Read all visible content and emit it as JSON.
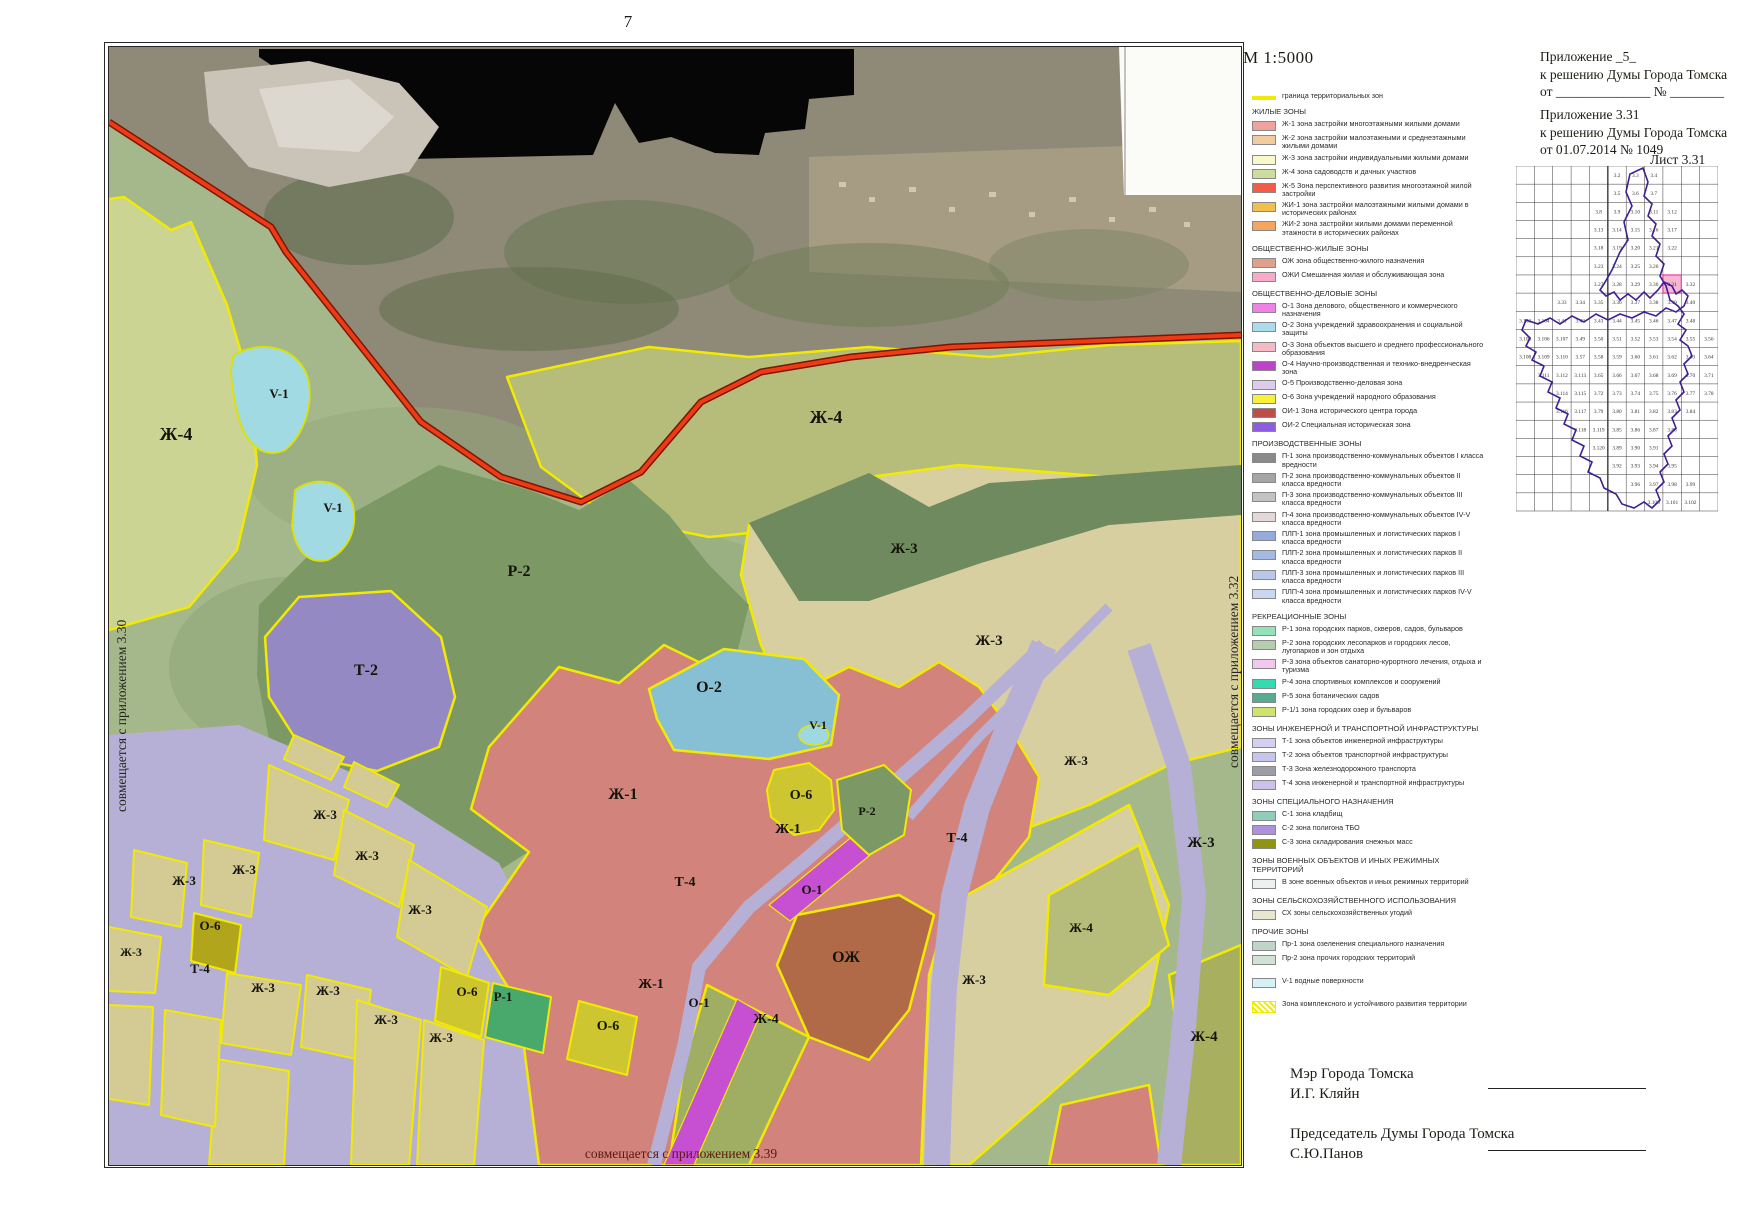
{
  "page": {
    "number": "7",
    "scale_label": "М 1:5000"
  },
  "header": {
    "appendix1": {
      "line1": "Приложение _5_",
      "line2": "к решению Думы Города Томска",
      "line3": "от ______________  № ________"
    },
    "appendix2": {
      "line1": "Приложение 3.31",
      "line2": "к решению Думы Города Томска",
      "line3": "от  01.07.2014  № 1049"
    },
    "sheet_label": "Лист 3.31"
  },
  "map": {
    "edge_captions": {
      "left": "совмещается с приложением 3.30",
      "right": "совмещается с приложением 3.32",
      "bottom": "совмещается с приложением 3.39"
    },
    "labels": [
      {
        "t": "Ж-4",
        "x": 67,
        "y": 393,
        "s": 18
      },
      {
        "t": "V-1",
        "x": 170,
        "y": 351,
        "s": 13
      },
      {
        "t": "V-1",
        "x": 224,
        "y": 465,
        "s": 13
      },
      {
        "t": "Ж-4",
        "x": 717,
        "y": 376,
        "s": 18
      },
      {
        "t": "Р-2",
        "x": 410,
        "y": 529,
        "s": 16
      },
      {
        "t": "Т-2",
        "x": 257,
        "y": 628,
        "s": 16
      },
      {
        "t": "Ж-3",
        "x": 795,
        "y": 506,
        "s": 15
      },
      {
        "t": "Ж-3",
        "x": 880,
        "y": 598,
        "s": 15
      },
      {
        "t": "О-2",
        "x": 600,
        "y": 645,
        "s": 16
      },
      {
        "t": "V-1",
        "x": 709,
        "y": 682,
        "s": 12
      },
      {
        "t": "Ж-1",
        "x": 514,
        "y": 752,
        "s": 16
      },
      {
        "t": "О-6",
        "x": 692,
        "y": 752,
        "s": 14
      },
      {
        "t": "Ж-1",
        "x": 679,
        "y": 786,
        "s": 14
      },
      {
        "t": "Р-2",
        "x": 758,
        "y": 768,
        "s": 12
      },
      {
        "t": "Т-4",
        "x": 848,
        "y": 795,
        "s": 14
      },
      {
        "t": "Ж-3",
        "x": 216,
        "y": 772,
        "s": 13
      },
      {
        "t": "Ж-3",
        "x": 258,
        "y": 813,
        "s": 13
      },
      {
        "t": "Ж-3",
        "x": 135,
        "y": 827,
        "s": 13
      },
      {
        "t": "Ж-3",
        "x": 75,
        "y": 838,
        "s": 13
      },
      {
        "t": "Ж-3",
        "x": 311,
        "y": 867,
        "s": 13
      },
      {
        "t": "О-6",
        "x": 101,
        "y": 883,
        "s": 13
      },
      {
        "t": "Ж-3",
        "x": 22,
        "y": 909,
        "s": 12
      },
      {
        "t": "Т-4",
        "x": 91,
        "y": 926,
        "s": 13
      },
      {
        "t": "Ж-3",
        "x": 154,
        "y": 945,
        "s": 13
      },
      {
        "t": "Ж-3",
        "x": 219,
        "y": 948,
        "s": 13
      },
      {
        "t": "О-6",
        "x": 358,
        "y": 949,
        "s": 13
      },
      {
        "t": "Р-1",
        "x": 394,
        "y": 954,
        "s": 13
      },
      {
        "t": "Ж-3",
        "x": 277,
        "y": 977,
        "s": 13
      },
      {
        "t": "Ж-3",
        "x": 332,
        "y": 995,
        "s": 13
      },
      {
        "t": "Т-4",
        "x": 576,
        "y": 839,
        "s": 14
      },
      {
        "t": "О-1",
        "x": 703,
        "y": 847,
        "s": 13
      },
      {
        "t": "Ж-1",
        "x": 542,
        "y": 941,
        "s": 14
      },
      {
        "t": "О-1",
        "x": 590,
        "y": 960,
        "s": 13
      },
      {
        "t": "О-6",
        "x": 499,
        "y": 983,
        "s": 14
      },
      {
        "t": "Ж-4",
        "x": 657,
        "y": 976,
        "s": 14
      },
      {
        "t": "ОЖ",
        "x": 737,
        "y": 915,
        "s": 16
      },
      {
        "t": "Ж-3",
        "x": 865,
        "y": 937,
        "s": 13
      },
      {
        "t": "Ж-4",
        "x": 972,
        "y": 885,
        "s": 13
      },
      {
        "t": "Ж-3",
        "x": 967,
        "y": 718,
        "s": 13
      },
      {
        "t": "Ж-3",
        "x": 1092,
        "y": 800,
        "s": 15
      },
      {
        "t": "Ж-4",
        "x": 1095,
        "y": 994,
        "s": 15
      }
    ]
  },
  "colors": {
    "zone_boundary_yellow": "#f2ea00",
    "city_border_red": "#ef3b14",
    "index_highlight_pink": "#f7b6d2",
    "index_boundary_purple": "#3d1f8f"
  },
  "legend": {
    "entries": [
      {
        "t": "item",
        "sw": "line",
        "c": "#f2ea00",
        "label": "граница территориальных зон"
      },
      {
        "t": "head",
        "label": "ЖИЛЫЕ ЗОНЫ"
      },
      {
        "t": "item",
        "c": "#f0a29e",
        "label": "Ж-1 зона застройки многоэтажными жилыми домами"
      },
      {
        "t": "item",
        "c": "#f3cba1",
        "label": "Ж-2 зона застройки малоэтажными и среднеэтажными жилыми домами"
      },
      {
        "t": "item",
        "c": "#f8f8cb",
        "label": "Ж-3 зона застройки индивидуальными жилыми домами"
      },
      {
        "t": "item",
        "c": "#cfdc9f",
        "label": "Ж-4 зона садоводств и дачных участков"
      },
      {
        "t": "item",
        "c": "#f25c4a",
        "label": "Ж-5 Зона перспективного развития многоэтажной жилой застройки"
      },
      {
        "t": "item",
        "c": "#f0bf4e",
        "label": "ЖИ-1 зона застройки малоэтажными жилыми домами в исторических районах"
      },
      {
        "t": "item",
        "c": "#f5a55f",
        "label": "ЖИ-2 зона застройки жилыми домами переменной этажности в исторических районах"
      },
      {
        "t": "head",
        "label": "ОБЩЕСТВЕННО-ЖИЛЫЕ ЗОНЫ"
      },
      {
        "t": "item",
        "c": "#dfa18b",
        "label": "ОЖ зона общественно-жилого назначения"
      },
      {
        "t": "item",
        "c": "#f8aacb",
        "label": "ОЖИ Смешанная жилая и обслуживающая зона"
      },
      {
        "t": "head",
        "label": "ОБЩЕСТВЕННО-ДЕЛОВЫЕ ЗОНЫ"
      },
      {
        "t": "item",
        "c": "#ee82e6",
        "label": "О-1 Зона делового, общественного и коммерческого назначения"
      },
      {
        "t": "item",
        "c": "#aadcec",
        "label": "О-2 Зона учреждений здравоохранения и социальной защиты"
      },
      {
        "t": "item",
        "c": "#f6bac6",
        "label": "О-3 Зона объектов высшего и среднего профессионального образования"
      },
      {
        "t": "item",
        "c": "#ba43c8",
        "label": "О-4 Научно-производственная и технико-внедренческая зона"
      },
      {
        "t": "item",
        "c": "#dccbe9",
        "label": "О-5 Производственно-деловая зона"
      },
      {
        "t": "item",
        "c": "#f7f13b",
        "label": "О-6 Зона учреждений народного образования"
      },
      {
        "t": "item",
        "c": "#bf4f46",
        "label": "ОИ-1 Зона исторического центра города"
      },
      {
        "t": "item",
        "c": "#8e5ce2",
        "label": "ОИ-2 Специальная историческая зона"
      },
      {
        "t": "head",
        "label": "ПРОИЗВОДСТВЕННЫЕ ЗОНЫ"
      },
      {
        "t": "item",
        "c": "#8a8a8a",
        "label": "П-1 зона производственно-коммунальных объектов I класса вредности"
      },
      {
        "t": "item",
        "c": "#a5a5a5",
        "label": "П-2 зона производственно-коммунальных объектов II класса вредности"
      },
      {
        "t": "item",
        "c": "#c3c3c3",
        "label": "П-3 зона производственно-коммунальных объектов III класса вредности"
      },
      {
        "t": "item",
        "c": "#e4d8d8",
        "label": "П-4 зона производственно-коммунальных объектов IV-V класса вредности"
      },
      {
        "t": "item",
        "c": "#95abdc",
        "label": "ПЛП-1 зона промышленных и логистических парков I класса вредности"
      },
      {
        "t": "item",
        "c": "#a6b9e4",
        "label": "ПЛП-2 зона промышленных и логистических парков II класса вредности"
      },
      {
        "t": "item",
        "c": "#b9c7ea",
        "label": "ПЛП-3 зона промышленных и логистических парков III класса вредности"
      },
      {
        "t": "item",
        "c": "#cbd6f0",
        "label": "ПЛП-4 зона промышленных и логистических парков IV-V класса вредности"
      },
      {
        "t": "head",
        "label": "РЕКРЕАЦИОННЫЕ ЗОНЫ"
      },
      {
        "t": "item",
        "c": "#93e2b9",
        "label": "Р-1 зона городских парков, скверов, садов, бульваров"
      },
      {
        "t": "item",
        "c": "#b6cdb0",
        "label": "Р-2 зона городских лесопарков и городских лесов, лугопарков и зон отдыха"
      },
      {
        "t": "item",
        "c": "#f3c8ee",
        "label": "Р-3 зона объектов санаторно-курортного лечения, отдыха и туризма"
      },
      {
        "t": "item",
        "c": "#35dbb0",
        "label": "Р-4 зона спортивных комплексов и сооружений"
      },
      {
        "t": "item",
        "c": "#58aa92",
        "label": "Р-5 зона ботанических садов"
      },
      {
        "t": "item",
        "c": "#cfe46e",
        "label": "Р-1/1 зона городских озер и бульваров"
      },
      {
        "t": "head",
        "label": "ЗОНЫ ИНЖЕНЕРНОЙ И ТРАНСПОРТНОЙ ИНФРАСТРУКТУРЫ"
      },
      {
        "t": "item",
        "c": "#d7cff2",
        "label": "Т-1 зона объектов инженерной инфраструктуры"
      },
      {
        "t": "item",
        "c": "#c5c5f0",
        "label": "Т-2 зона объектов транспортной инфраструктуры"
      },
      {
        "t": "item",
        "c": "#9d9da6",
        "label": "Т-3 Зона железнодорожного транспорта"
      },
      {
        "t": "item",
        "c": "#cbc1ea",
        "label": "Т-4 зона инженерной и транспортной инфраструктуры"
      },
      {
        "t": "head",
        "label": "ЗОНЫ СПЕЦИАЛЬНОГО НАЗНАЧЕНИЯ"
      },
      {
        "t": "item",
        "c": "#90ccba",
        "label": "С-1 зона кладбищ"
      },
      {
        "t": "item",
        "c": "#ad91de",
        "label": "С-2 зона полигона ТБО"
      },
      {
        "t": "item",
        "c": "#8f9412",
        "label": "С-3 зона складирования снежных масс"
      },
      {
        "t": "head",
        "label": "ЗОНЫ ВОЕННЫХ ОБЪЕКТОВ И ИНЫХ РЕЖИМНЫХ ТЕРРИТОРИЙ"
      },
      {
        "t": "item",
        "c": "#edf1ed",
        "label": "В зоне военных объектов и иных режимных территорий"
      },
      {
        "t": "head",
        "label": "ЗОНЫ СЕЛЬСКОХОЗЯЙСТВЕННОГО ИСПОЛЬЗОВАНИЯ"
      },
      {
        "t": "item",
        "c": "#e8e8d1",
        "label": "СХ зоны сельскохозяйственных угодий"
      },
      {
        "t": "head",
        "label": "ПРОЧИЕ ЗОНЫ"
      },
      {
        "t": "item",
        "c": "#c0d4c8",
        "label": "Пр-1 зона озеленения специального назначения"
      },
      {
        "t": "item",
        "c": "#d1e2d6",
        "label": "Пр-2 зона прочих городских территорий"
      },
      {
        "t": "gap"
      },
      {
        "t": "item",
        "c": "#d4f1f7",
        "label": "V-1 водные поверхности"
      },
      {
        "t": "gap"
      },
      {
        "t": "item",
        "sw": "hatch",
        "c": "#f2ea00",
        "label": "Зона комплексного и устойчивого развития территории"
      }
    ]
  },
  "index_map": {
    "highlight": "3.31",
    "cells": [
      [
        0,
        5,
        "3.2"
      ],
      [
        0,
        6,
        "3.3"
      ],
      [
        0,
        7,
        "3.4"
      ],
      [
        1,
        5,
        "3.5"
      ],
      [
        1,
        6,
        "3.6"
      ],
      [
        1,
        7,
        "3.7"
      ],
      [
        2,
        4,
        "3.8"
      ],
      [
        2,
        5,
        "3.9"
      ],
      [
        2,
        6,
        "3.10"
      ],
      [
        2,
        7,
        "3.11"
      ],
      [
        2,
        8,
        "3.12"
      ],
      [
        3,
        4,
        "3.13"
      ],
      [
        3,
        5,
        "3.14"
      ],
      [
        3,
        6,
        "3.15"
      ],
      [
        3,
        7,
        "3.16"
      ],
      [
        3,
        8,
        "3.17"
      ],
      [
        4,
        4,
        "3.18"
      ],
      [
        4,
        5,
        "3.19"
      ],
      [
        4,
        6,
        "3.20"
      ],
      [
        4,
        7,
        "3.21"
      ],
      [
        4,
        8,
        "3.22"
      ],
      [
        5,
        4,
        "3.23"
      ],
      [
        5,
        5,
        "3.24"
      ],
      [
        5,
        6,
        "3.25"
      ],
      [
        5,
        7,
        "3.26"
      ],
      [
        6,
        4,
        "3.27"
      ],
      [
        6,
        5,
        "3.28"
      ],
      [
        6,
        6,
        "3.29"
      ],
      [
        6,
        7,
        "3.30"
      ],
      [
        6,
        8,
        "3.31"
      ],
      [
        6,
        9,
        "3.32"
      ],
      [
        7,
        2,
        "3.33"
      ],
      [
        7,
        3,
        "3.34"
      ],
      [
        7,
        4,
        "3.35"
      ],
      [
        7,
        5,
        "3.36"
      ],
      [
        7,
        6,
        "3.37"
      ],
      [
        7,
        7,
        "3.38"
      ],
      [
        7,
        8,
        "3.39"
      ],
      [
        7,
        9,
        "3.40"
      ],
      [
        8,
        0,
        "3.103"
      ],
      [
        8,
        1,
        "3.104"
      ],
      [
        8,
        2,
        "3.41"
      ],
      [
        8,
        3,
        "3.42"
      ],
      [
        8,
        4,
        "3.43"
      ],
      [
        8,
        5,
        "3.44"
      ],
      [
        8,
        6,
        "3.45"
      ],
      [
        8,
        7,
        "3.46"
      ],
      [
        8,
        8,
        "3.47"
      ],
      [
        8,
        9,
        "3.48"
      ],
      [
        9,
        0,
        "3.105"
      ],
      [
        9,
        1,
        "3.106"
      ],
      [
        9,
        2,
        "3.107"
      ],
      [
        9,
        3,
        "3.49"
      ],
      [
        9,
        4,
        "3.50"
      ],
      [
        9,
        5,
        "3.51"
      ],
      [
        9,
        6,
        "3.52"
      ],
      [
        9,
        7,
        "3.53"
      ],
      [
        9,
        8,
        "3.54"
      ],
      [
        9,
        9,
        "3.55"
      ],
      [
        9,
        10,
        "3.56"
      ],
      [
        10,
        0,
        "3.108"
      ],
      [
        10,
        1,
        "3.109"
      ],
      [
        10,
        2,
        "3.110"
      ],
      [
        10,
        3,
        "3.57"
      ],
      [
        10,
        4,
        "3.58"
      ],
      [
        10,
        5,
        "3.59"
      ],
      [
        10,
        6,
        "3.60"
      ],
      [
        10,
        7,
        "3.61"
      ],
      [
        10,
        8,
        "3.62"
      ],
      [
        10,
        9,
        "3.63"
      ],
      [
        10,
        10,
        "3.64"
      ],
      [
        11,
        1,
        "3.111"
      ],
      [
        11,
        2,
        "3.112"
      ],
      [
        11,
        3,
        "3.113"
      ],
      [
        11,
        4,
        "3.65"
      ],
      [
        11,
        5,
        "3.66"
      ],
      [
        11,
        6,
        "3.67"
      ],
      [
        11,
        7,
        "3.68"
      ],
      [
        11,
        8,
        "3.69"
      ],
      [
        11,
        9,
        "3.70"
      ],
      [
        11,
        10,
        "3.71"
      ],
      [
        12,
        2,
        "3.114"
      ],
      [
        12,
        3,
        "3.115"
      ],
      [
        12,
        4,
        "3.72"
      ],
      [
        12,
        5,
        "3.73"
      ],
      [
        12,
        6,
        "3.74"
      ],
      [
        12,
        7,
        "3.75"
      ],
      [
        12,
        8,
        "3.76"
      ],
      [
        12,
        9,
        "3.77"
      ],
      [
        12,
        10,
        "3.78"
      ],
      [
        13,
        2,
        "3.116"
      ],
      [
        13,
        3,
        "3.117"
      ],
      [
        13,
        4,
        "3.79"
      ],
      [
        13,
        5,
        "3.80"
      ],
      [
        13,
        6,
        "3.81"
      ],
      [
        13,
        7,
        "3.82"
      ],
      [
        13,
        8,
        "3.83"
      ],
      [
        13,
        9,
        "3.84"
      ],
      [
        14,
        3,
        "3.118"
      ],
      [
        14,
        4,
        "3.119"
      ],
      [
        14,
        5,
        "3.85"
      ],
      [
        14,
        6,
        "3.86"
      ],
      [
        14,
        7,
        "3.87"
      ],
      [
        14,
        8,
        "3.88"
      ],
      [
        15,
        4,
        "3.120"
      ],
      [
        15,
        5,
        "3.89"
      ],
      [
        15,
        6,
        "3.90"
      ],
      [
        15,
        7,
        "3.91"
      ],
      [
        16,
        5,
        "3.92"
      ],
      [
        16,
        6,
        "3.93"
      ],
      [
        16,
        7,
        "3.94"
      ],
      [
        16,
        8,
        "3.95"
      ],
      [
        17,
        6,
        "3.96"
      ],
      [
        17,
        7,
        "3.97"
      ],
      [
        17,
        8,
        "3.98"
      ],
      [
        17,
        9,
        "3.99"
      ],
      [
        18,
        7,
        "3.100"
      ],
      [
        18,
        8,
        "3.101"
      ],
      [
        18,
        9,
        "3.102"
      ]
    ]
  },
  "signatures": [
    {
      "title": "Мэр Города Томска",
      "name": "И.Г. Кляйн"
    },
    {
      "title": "Председатель Думы Города Томска",
      "name": "С.Ю.Панов"
    }
  ]
}
